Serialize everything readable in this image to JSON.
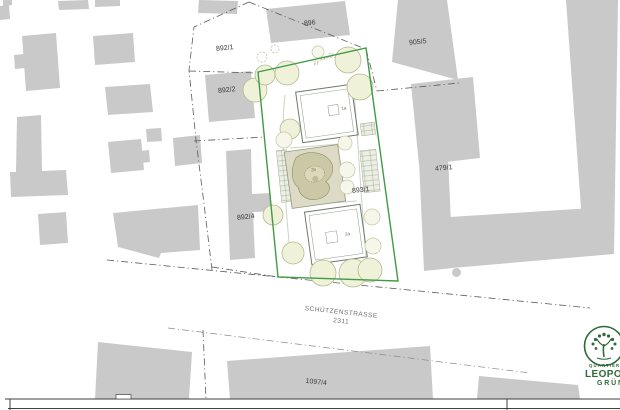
{
  "labels": {
    "parcels": [
      {
        "text": "896"
      },
      {
        "text": "892/1"
      },
      {
        "text": "892/2"
      },
      {
        "text": "892/4"
      },
      {
        "text": "905/5"
      },
      {
        "text": "479/1"
      },
      {
        "text": "893/1"
      },
      {
        "text": "1097/4"
      }
    ],
    "street": {
      "name": "SCHÜTZENSTRASSE",
      "number": "2311"
    },
    "site": {
      "building_top": "1a",
      "garden": "2b",
      "building_bottom": "2a"
    }
  },
  "logo": {
    "word1": "QUARTIER",
    "word2": "LEOPOLD",
    "word3": "GRÜN"
  },
  "colors": {
    "site_boundary_green": "#3f9b45",
    "building_gray": "#c9c9c9",
    "logo_green": "#2e6b3a",
    "boundary_line_gray": "#5a5a5a",
    "tree_fill": "#eff1d9",
    "tree_stroke": "#b4ba8c",
    "street_text_gray": "#6f6f6f",
    "parcel_label_gray": "#3a3a3a"
  }
}
